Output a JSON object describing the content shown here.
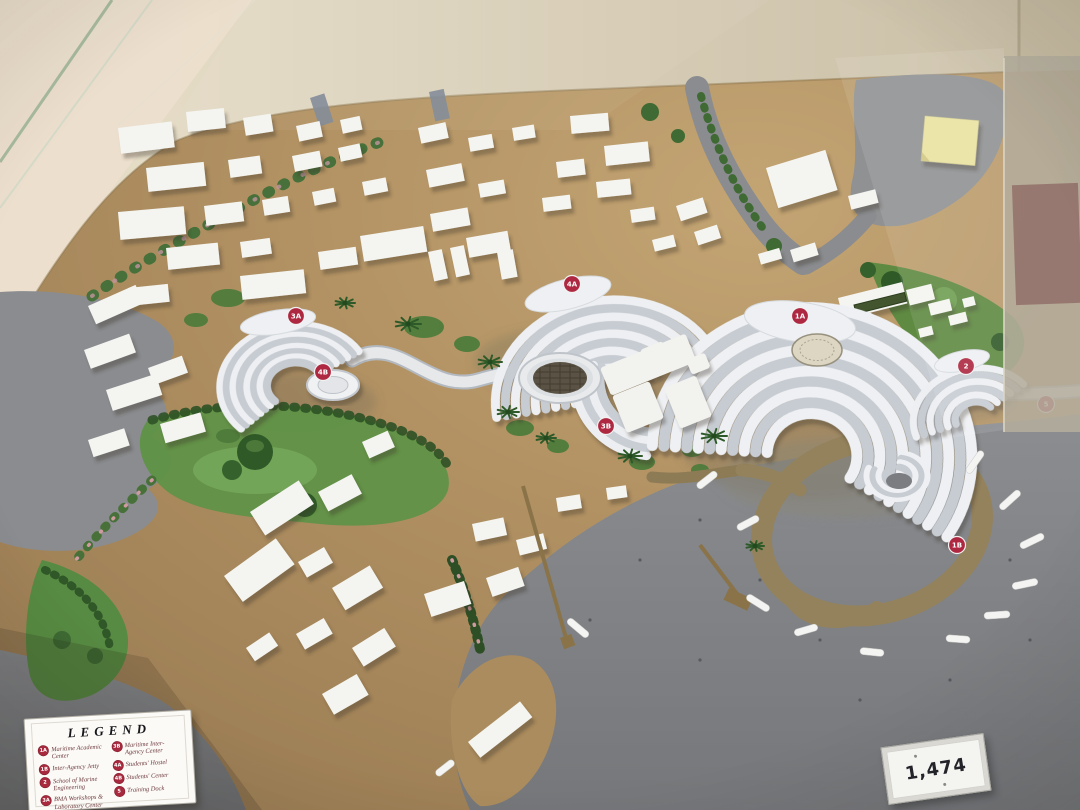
{
  "legend": {
    "title": "LEGEND",
    "entries_left": [
      {
        "badge": "1A",
        "label": "Maritime Academic Center"
      },
      {
        "badge": "1B",
        "label": "Inter-Agency Jetty"
      },
      {
        "badge": "2",
        "label": "School of Marine Engineering"
      },
      {
        "badge": "3A",
        "label": "BMA Workshops & Laboratory Center"
      }
    ],
    "entries_right": [
      {
        "badge": "3B",
        "label": "Maritime Inter-Agency Center"
      },
      {
        "badge": "4A",
        "label": "Students' Hostel"
      },
      {
        "badge": "4B",
        "label": "Students' Center"
      },
      {
        "badge": "5",
        "label": "Training Dock"
      }
    ]
  },
  "model_number_card": {
    "value": "1,474"
  },
  "markers": [
    {
      "label": "1A"
    },
    {
      "label": "4A"
    },
    {
      "label": "3A"
    },
    {
      "label": "4B"
    },
    {
      "label": "3B"
    },
    {
      "label": "2"
    },
    {
      "label": "5"
    },
    {
      "label": "1B"
    }
  ],
  "colors": {
    "badge_red": "#a8293d",
    "board_tan": "#b29263",
    "water_gray": "#85878b",
    "vegetation_green": "#5f9247",
    "building_white": "#f4f4f1",
    "sticky_note_yellow": "#e9e2a0"
  }
}
